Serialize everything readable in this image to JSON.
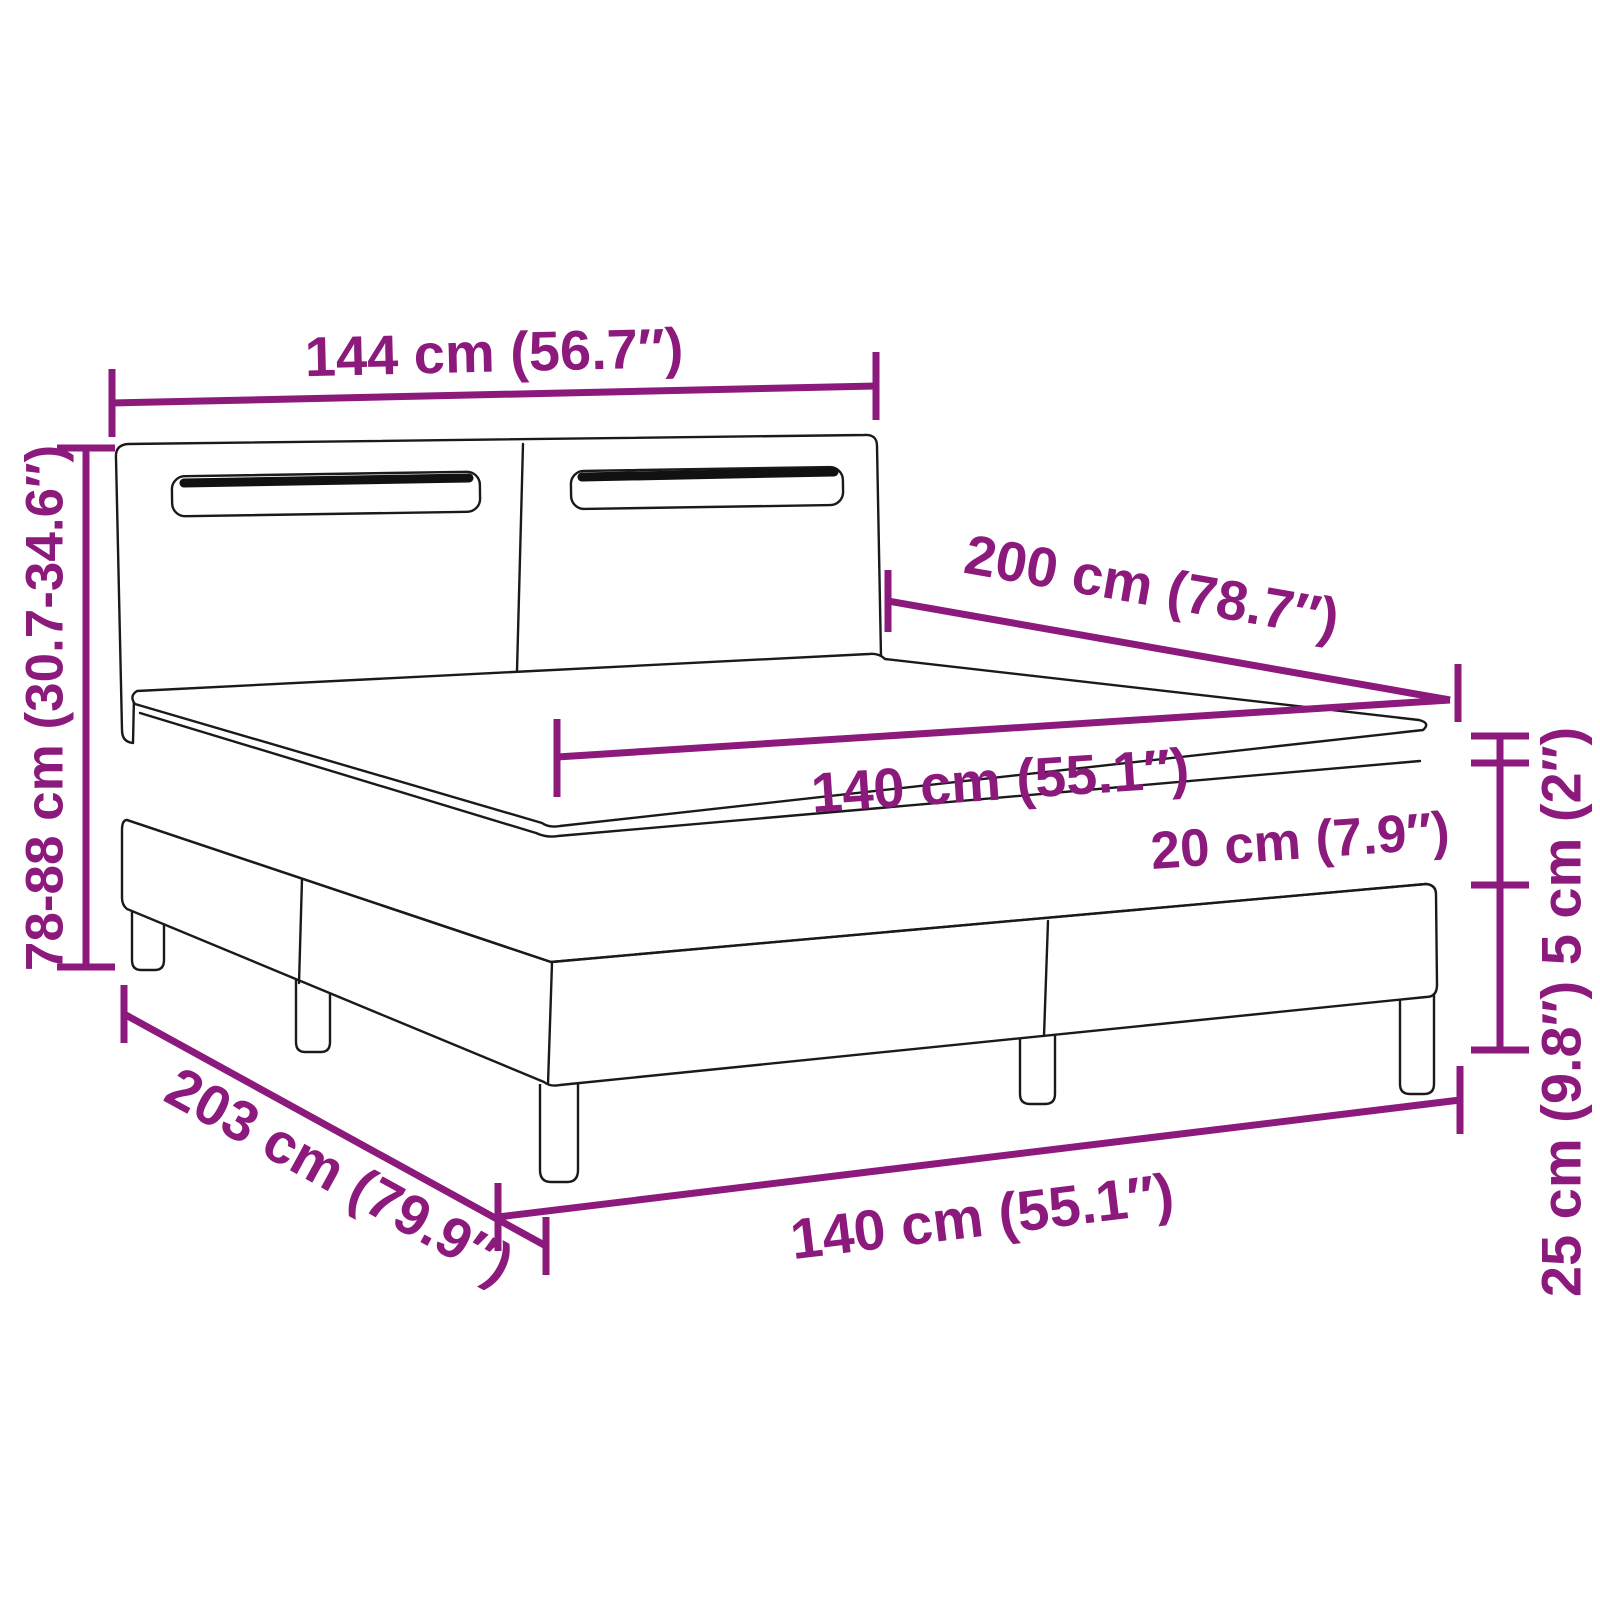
{
  "page": {
    "width": 1600,
    "height": 1600,
    "background": "#ffffff"
  },
  "diagram": {
    "subject": "box-spring-bed-with-led-headboard-dimension-diagram",
    "accent_color": "#8C1A7C",
    "line_color": "#1a1a1a",
    "labels": {
      "headboard_width": "144 cm (56.7″)",
      "headboard_height": "78-88 cm (30.7-34.6″)",
      "bed_length": "200 cm (78.7″)",
      "mattress_width": "140 cm (55.1″)",
      "mattress_height": "20 cm (7.9″)",
      "right_heights": "25 cm (9.8″) 5 cm (2″)",
      "base_length": "203 cm (79.9″)",
      "base_width": "140 cm (55.1″)"
    },
    "values": {
      "headboard_width_cm": 144,
      "headboard_width_in": 56.7,
      "headboard_height_min_cm": 78,
      "headboard_height_max_cm": 88,
      "headboard_height_min_in": 30.7,
      "headboard_height_max_in": 34.6,
      "bed_length_cm": 200,
      "bed_length_in": 78.7,
      "mattress_width_cm": 140,
      "mattress_width_in": 55.1,
      "mattress_height_cm": 20,
      "mattress_height_in": 7.9,
      "topper_height_cm": 5,
      "topper_height_in": 2,
      "base_height_cm": 25,
      "base_height_in": 9.8,
      "base_length_cm": 203,
      "base_length_in": 79.9,
      "base_width_cm": 140,
      "base_width_in": 55.1
    }
  }
}
